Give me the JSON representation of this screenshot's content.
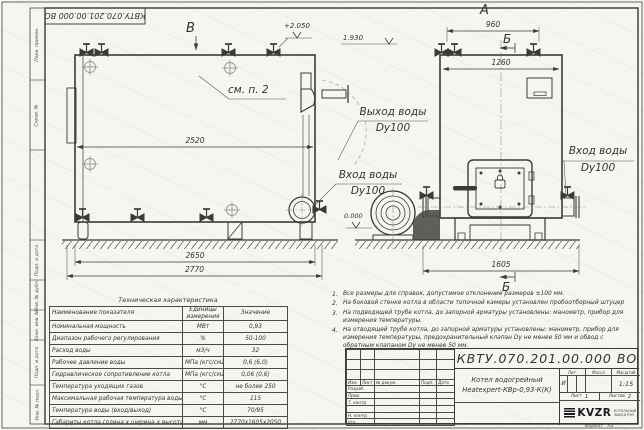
{
  "doc_number": "КВТУ.070.201.00.000 ВО",
  "margin_labels": [
    "Перв. примен.",
    "Справ. №",
    "Подп. и дата",
    "Инв. № дубл.",
    "Взам. инв. №",
    "Подп. и дата",
    "Инв. № подл."
  ],
  "drawing": {
    "view_letters": {
      "a": "А",
      "b_top": "Б",
      "b_bottom": "Б",
      "v": "В"
    },
    "note_ref": "см. п. 2",
    "elevations": {
      "top": "+2.050",
      "outlet": "1.930",
      "zero": "0.000"
    },
    "dims": {
      "side_inner": "2520",
      "side_frame": "2650",
      "side_total": "2770",
      "front_top": "960",
      "front_width": "1260",
      "front_base": "1605"
    },
    "ports": {
      "outlet_line1": "Выход воды",
      "outlet_line2": "Dy100",
      "inlet_side_line1": "Вход воды",
      "inlet_side_line2": "Dy100",
      "inlet_front_line1": "Вход воды",
      "inlet_front_line2": "Dy100"
    }
  },
  "tech_table": {
    "title": "Техническая характеристика",
    "headers": [
      "Наименование показателя",
      "Единицы измерения",
      "Значение"
    ],
    "rows": [
      [
        "Номинальная мощность",
        "МВт",
        "0,93"
      ],
      [
        "Диапазон рабочего регулирования",
        "%",
        "50-100"
      ],
      [
        "Расход воды",
        "м3/ч",
        "32"
      ],
      [
        "Рабочее давление воды",
        "МПа (кгс/см2)",
        "0,6 (6,0)"
      ],
      [
        "Гидравлическое сопротивление котла",
        "МПа (кгс/см2)",
        "0,06 (0,6)"
      ],
      [
        "Температура уходящих газов",
        "°С",
        "не более 250"
      ],
      [
        "Максимальная рабочая температура воды",
        "°С",
        "115"
      ],
      [
        "Температура воды (вход/выход)",
        "°С",
        "70/95"
      ],
      [
        "Габариты котла (длина х ширина х высота)",
        "мм",
        "2770х1605х2050"
      ]
    ]
  },
  "notes": [
    {
      "n": "1.",
      "text": "Все размеры для справок, допустимое отклонение размеров ±100 мм."
    },
    {
      "n": "2.",
      "text": "На боковой стенке котла в области топочной камеры установлен пробоотборный штуцер"
    },
    {
      "n": "3.",
      "text": "На подводящей трубе котла, до запорной арматуры установлены: манометр, прибор для измерения температуры."
    },
    {
      "n": "4.",
      "text": "На отводящей трубе котла, до запорной арматуры установлены: манометр, прибор для измерения температуры, предохранительный клапан Dу не менее 50 мм и обвод с обратным клапаном Dу не менее 50 мм."
    }
  ],
  "title_block": {
    "change_cols": [
      "Изм.",
      "Лист",
      "№ докум.",
      "Подп.",
      "Дата"
    ],
    "sign_rows": [
      "Разраб.",
      "Пров.",
      "Т. контр.",
      "",
      "Н. контр.",
      "Утв."
    ],
    "product_line1": "Котел водогрейный",
    "product_line2": "Heatexpert-КВр-0,93-К(К)",
    "lit_label": "Лит.",
    "mass_label": "Масса",
    "scale_label": "Масштаб",
    "lit_value": "И",
    "scale_value": "1:15",
    "sheet_label": "Лист",
    "sheet_value": "1",
    "sheets_label": "Листов",
    "sheets_value": "2",
    "logo_text": "KVZR",
    "logo_sub1": "КОТЕЛЬНЫЙ",
    "logo_sub2": "ЗАВОД РЭП",
    "format_label": "Формат",
    "format_value": "А3"
  }
}
